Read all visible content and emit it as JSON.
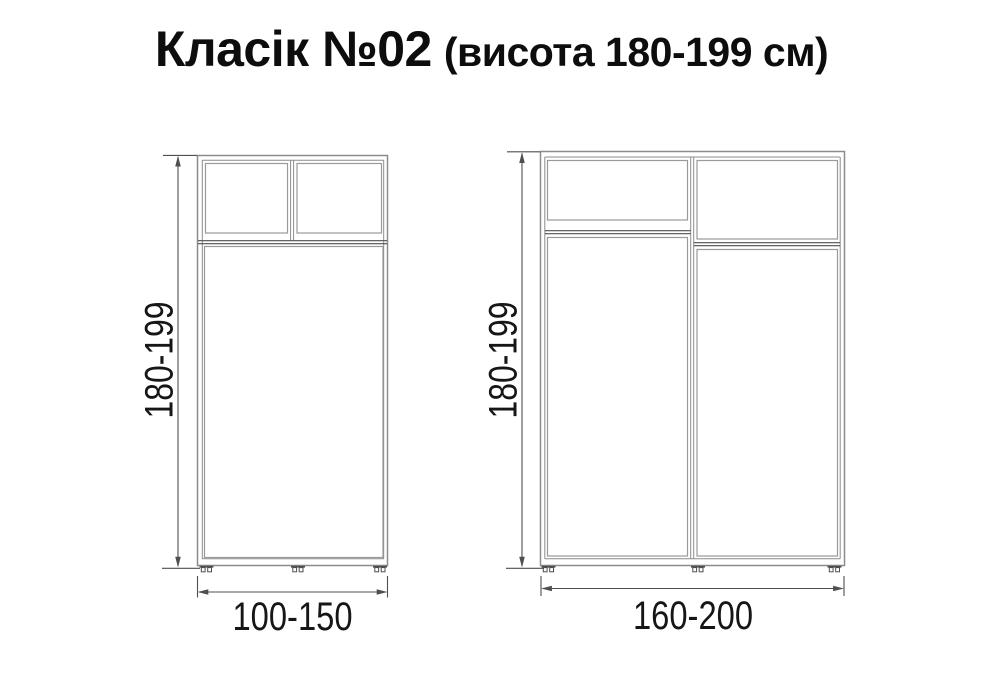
{
  "title": {
    "main": "Класік №02",
    "suffix": "(висота 180-199 см)"
  },
  "colors": {
    "background": "#ffffff",
    "carcass_line": "#8c8c8c",
    "door_line": "#9a9a9a",
    "accent_line": "#4f4f4f",
    "dim_line": "#4f4f4f",
    "text": "#161616",
    "title": "#0d0d0d"
  },
  "wardrobes": [
    {
      "id": "small",
      "height_label": "180-199",
      "width_label": "100-150"
    },
    {
      "id": "large",
      "height_label": "180-199",
      "width_label": "160-200"
    }
  ]
}
